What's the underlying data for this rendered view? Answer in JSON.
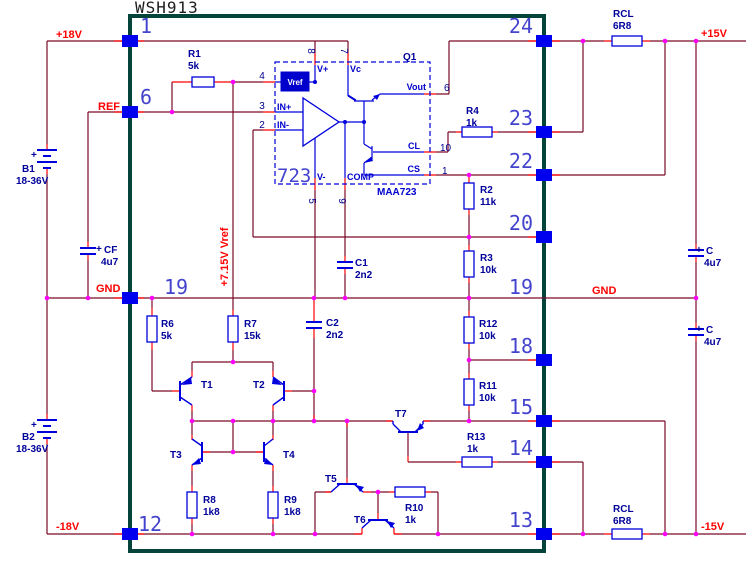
{
  "title": "WSH913",
  "nets": {
    "p18v": "+18V",
    "ref": "REF",
    "gnd_l": "GND",
    "m18v": "-18V",
    "p15v": "+15V",
    "m15v": "-15V",
    "gnd_r": "GND",
    "vref_rail": "+7.15V Vref"
  },
  "pins_left": [
    "1",
    "6",
    "19",
    "12"
  ],
  "pins_right": [
    "24",
    "23",
    "22",
    "20",
    "19",
    "18",
    "15",
    "14",
    "13"
  ],
  "batteries": [
    {
      "ref": "B1",
      "value": "18-36V",
      "polarity": "+"
    },
    {
      "ref": "B2",
      "value": "18-36V",
      "polarity": "+"
    }
  ],
  "capacitors": [
    {
      "ref": "CF",
      "value": "4u7",
      "polarity": "+"
    },
    {
      "ref": "C1",
      "value": "2n2"
    },
    {
      "ref": "C2",
      "value": "2n2"
    },
    {
      "ref": "C",
      "value": "4u7",
      "polarity": "+"
    },
    {
      "ref": "C",
      "value": "4u7",
      "polarity": "+"
    }
  ],
  "resistors": [
    {
      "ref": "R1",
      "value": "5k"
    },
    {
      "ref": "R2",
      "value": "11k"
    },
    {
      "ref": "R3",
      "value": "10k"
    },
    {
      "ref": "R4",
      "value": "1k"
    },
    {
      "ref": "R6",
      "value": "5k"
    },
    {
      "ref": "R7",
      "value": "15k"
    },
    {
      "ref": "R8",
      "value": "1k8"
    },
    {
      "ref": "R9",
      "value": "1k8"
    },
    {
      "ref": "R10",
      "value": "1k"
    },
    {
      "ref": "R11",
      "value": "10k"
    },
    {
      "ref": "R12",
      "value": "10k"
    },
    {
      "ref": "R13",
      "value": "1k"
    },
    {
      "ref": "RCL",
      "value": "6R8"
    },
    {
      "ref": "RCL",
      "value": "6R8"
    }
  ],
  "transistors": [
    "T1",
    "T2",
    "T3",
    "T4",
    "T5",
    "T6",
    "T7"
  ],
  "regulator": {
    "big_label": "723",
    "part": "MAA723",
    "q1": "Q1",
    "labels": {
      "vref": "Vref",
      "vplus": "V+",
      "vc": "Vc",
      "vout": "Vout",
      "cl": "CL",
      "cs": "CS",
      "vminus": "V-",
      "comp": "COMP",
      "in_p": "IN+",
      "in_m": "IN-"
    },
    "pins": {
      "n8": "8",
      "n7": "7",
      "n4": "4",
      "n3": "3",
      "n2": "2",
      "n6": "6",
      "n10": "10",
      "n1": "1",
      "n5": "5",
      "n9": "9"
    }
  }
}
